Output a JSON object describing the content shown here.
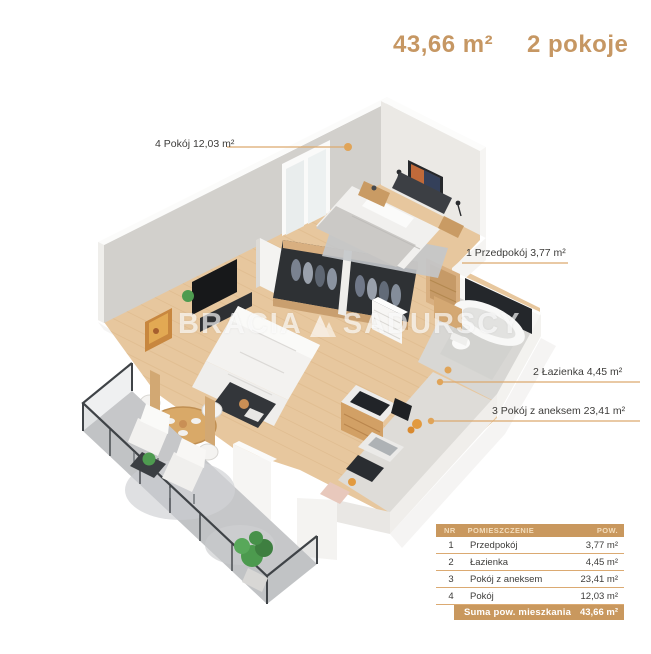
{
  "header": {
    "area": "43,66 m²",
    "rooms": "2 pokoje"
  },
  "watermark": {
    "left": "BRACIA",
    "right": "SADURSCY",
    "logo_icon": "mountain-logo-icon"
  },
  "plan_labels": [
    {
      "nr": "4",
      "text": "4 Pokój 12,03 m²"
    },
    {
      "nr": "1",
      "text": "1 Przedpokój 3,77 m²"
    },
    {
      "nr": "2",
      "text": "2 Łazienka 4,45 m²"
    },
    {
      "nr": "3",
      "text": "3 Pokój z aneksem 23,41 m²"
    }
  ],
  "table": {
    "headers": {
      "nr": "NR",
      "room": "POMIESZCZENIE",
      "area": "POW."
    },
    "rows": [
      {
        "nr": "1",
        "room": "Przedpokój",
        "area": "3,77 m²"
      },
      {
        "nr": "2",
        "room": "Łazienka",
        "area": "4,45 m²"
      },
      {
        "nr": "3",
        "room": "Pokój z aneksem",
        "area": "23,41 m²"
      },
      {
        "nr": "4",
        "room": "Pokój",
        "area": "12,03 m²"
      }
    ],
    "footer": {
      "label": "Suma pow. mieszkania",
      "value": "43,66 m²"
    }
  },
  "colors": {
    "accent_text": "#C69763",
    "leader_line": "#DCA96E",
    "leader_dot": "#E0A458",
    "table_header_bg": "#C9985E",
    "row_separator": "#DBAA72",
    "label_text": "#3D3C3A",
    "wood_floor": "#E7C79E",
    "concrete_floor": "#C6C7C9"
  }
}
